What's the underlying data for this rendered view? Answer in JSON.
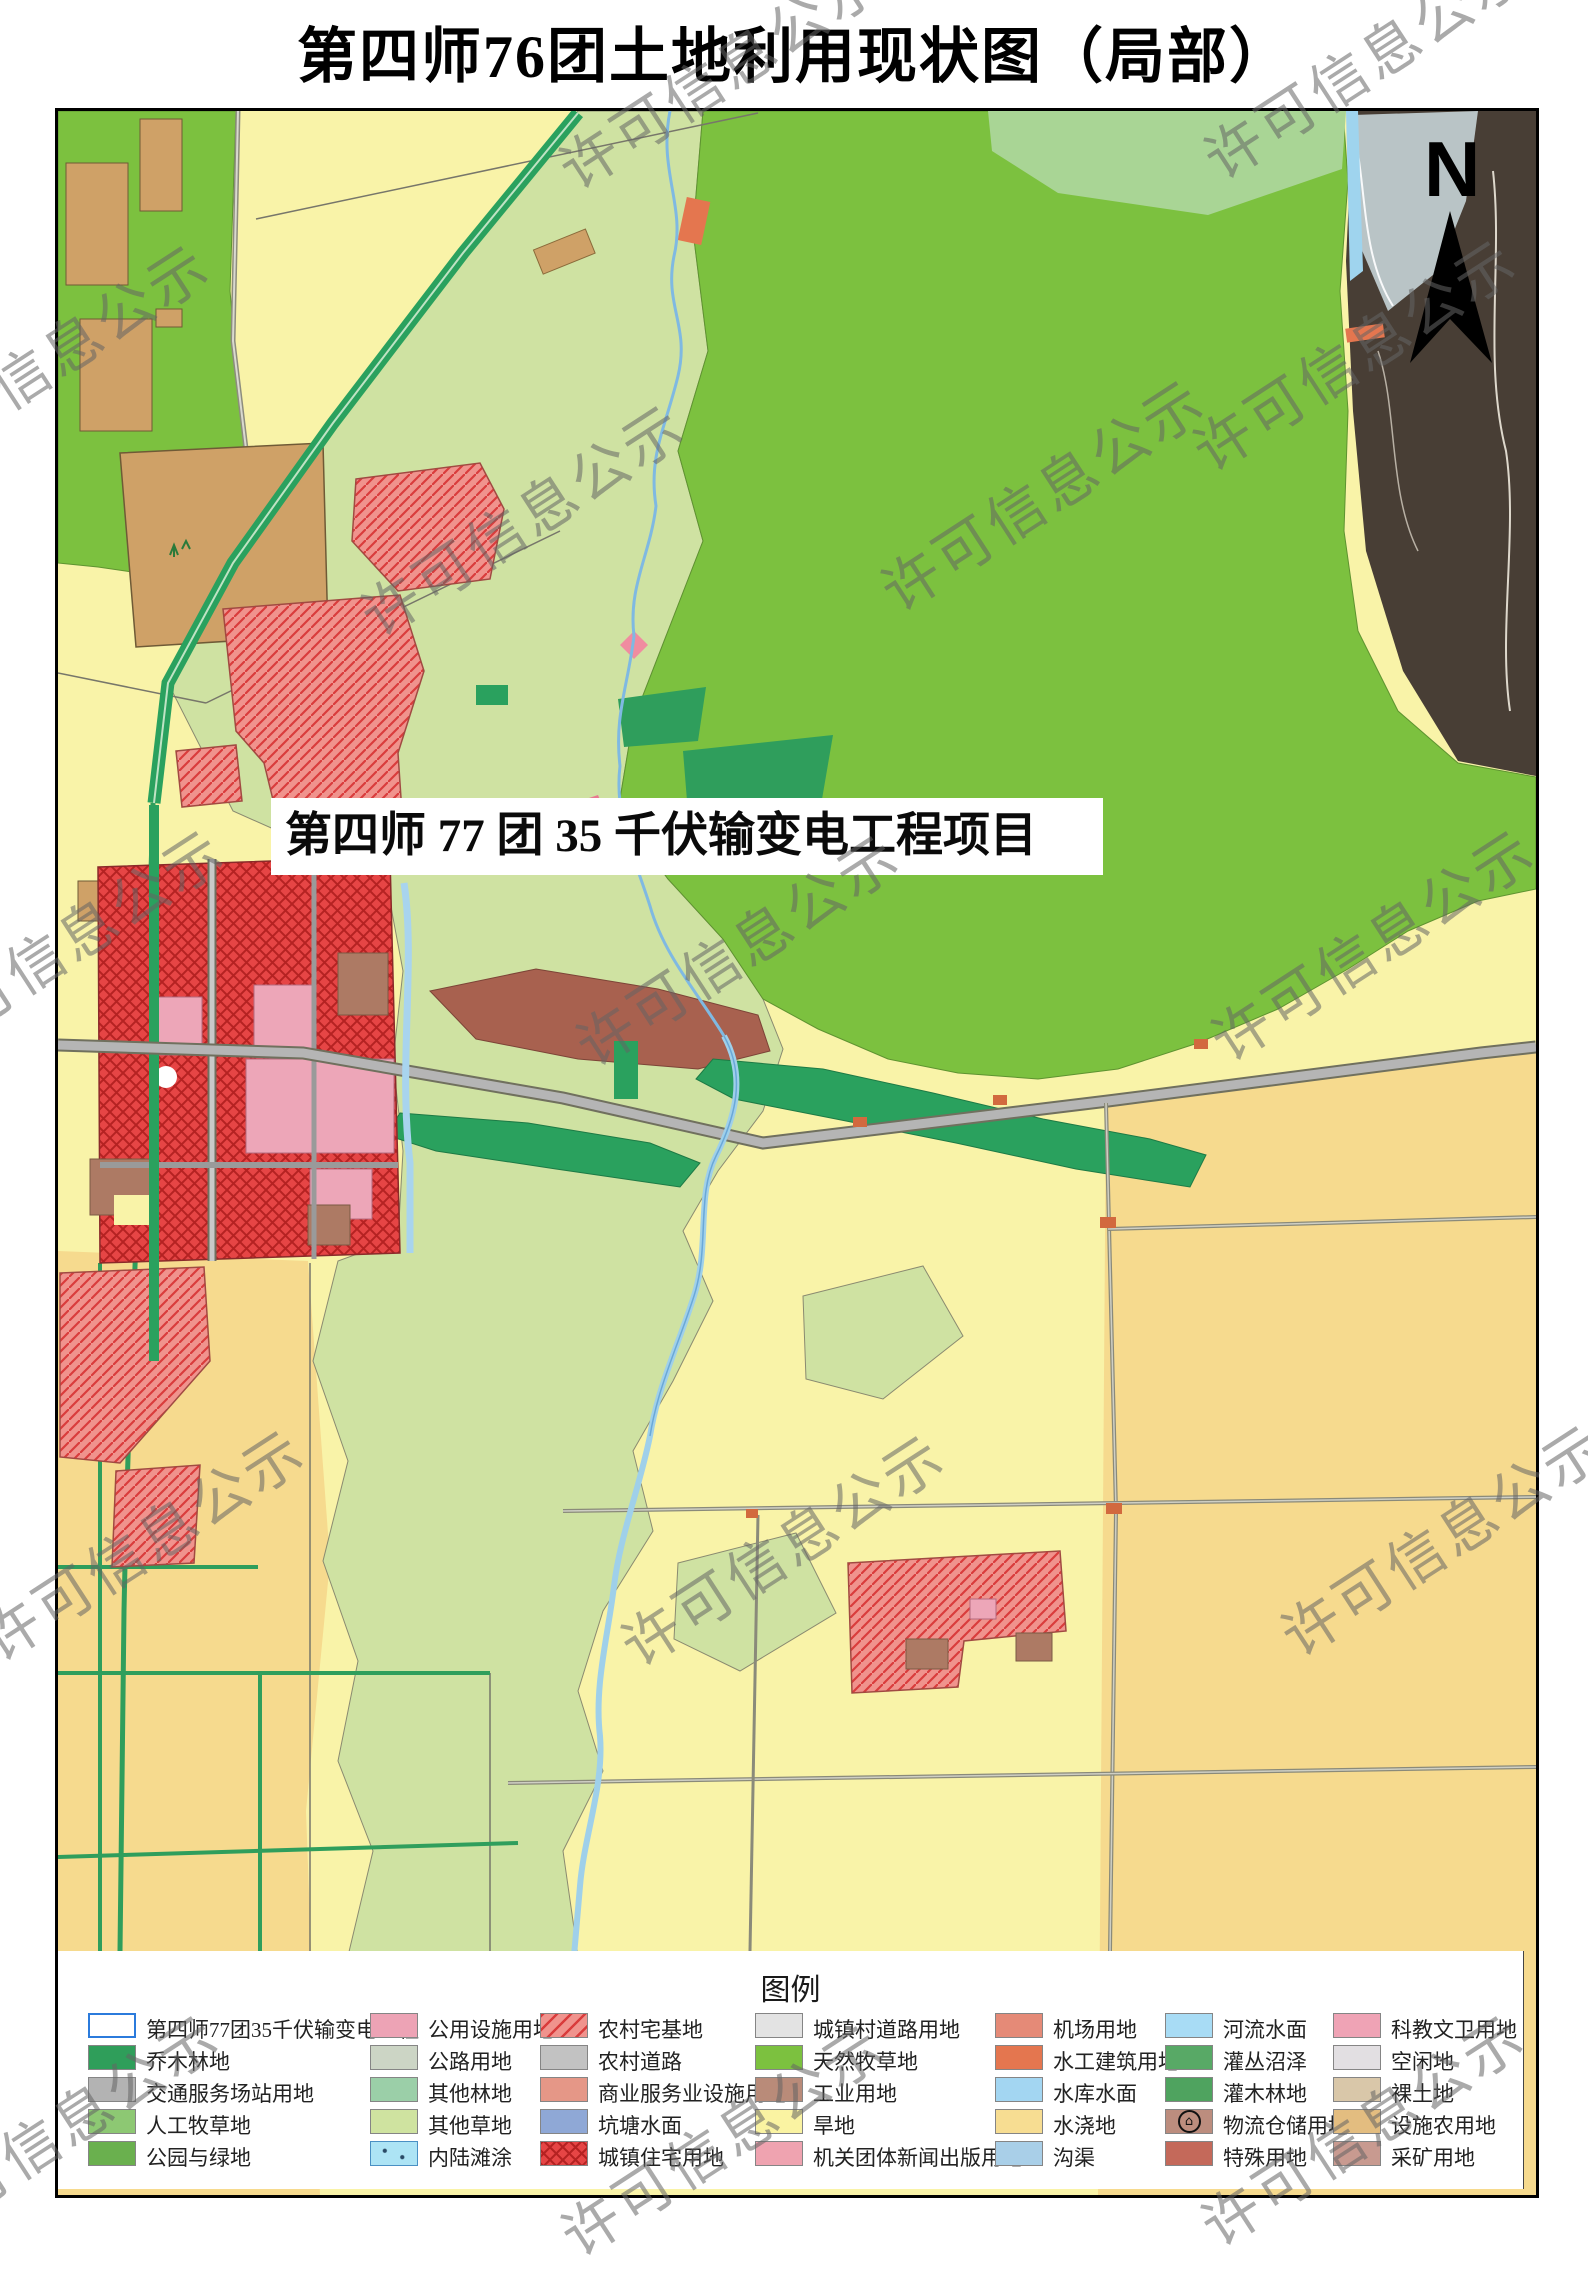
{
  "title": "第四师76团土地利用现状图（局部）",
  "map": {
    "project_label": "第四师 77 团 35 千伏输变电工程项目",
    "north_label": "N"
  },
  "watermark": {
    "text": "许可信息公示"
  },
  "legend": {
    "title": "图例",
    "columns": [
      {
        "items": [
          {
            "label": "第四师77团35千伏输变电工程",
            "color": "#ffffff",
            "pattern": "project"
          },
          {
            "label": "乔木林地",
            "color": "#2f9e5a",
            "pattern": "solid"
          },
          {
            "label": "交通服务场站用地",
            "color": "#b3b3b3",
            "pattern": "solid"
          },
          {
            "label": "人工牧草地",
            "color": "#8dc873",
            "pattern": "solid"
          },
          {
            "label": "公园与绿地",
            "color": "#6ab04e",
            "pattern": "solid"
          }
        ]
      },
      {
        "items": [
          {
            "label": "公用设施用地",
            "color": "#eda3b5",
            "pattern": "solid"
          },
          {
            "label": "公路用地",
            "color": "#ccd5c5",
            "pattern": "solid"
          },
          {
            "label": "其他林地",
            "color": "#9bcfa8",
            "pattern": "solid"
          },
          {
            "label": "其他草地",
            "color": "#cfe3a0",
            "pattern": "solid"
          },
          {
            "label": "内陆滩涂",
            "color": "#ade4f5",
            "pattern": "dots",
            "pattern_color": "#2a4a66"
          }
        ]
      },
      {
        "items": [
          {
            "label": "农村宅基地",
            "color": "#f0938d",
            "pattern": "diag",
            "pattern_color": "#d93c3c"
          },
          {
            "label": "农村道路",
            "color": "#c2c2c2",
            "pattern": "solid"
          },
          {
            "label": "商业服务业设施用地",
            "color": "#e59787",
            "pattern": "solid"
          },
          {
            "label": "坑塘水面",
            "color": "#8fa8d6",
            "pattern": "solid"
          },
          {
            "label": "城镇住宅用地",
            "color": "#e64545",
            "pattern": "cross",
            "pattern_color": "#b52222"
          }
        ]
      },
      {
        "items": [
          {
            "label": "城镇村道路用地",
            "color": "#e3e3e3",
            "pattern": "solid"
          },
          {
            "label": "天然牧草地",
            "color": "#7cc13f",
            "pattern": "solid"
          },
          {
            "label": "工业用地",
            "color": "#b98b79",
            "pattern": "solid"
          },
          {
            "label": "旱地",
            "color": "#faf3a2",
            "pattern": "solid"
          },
          {
            "label": "机关团体新闻出版用地",
            "color": "#efa3b0",
            "pattern": "solid"
          }
        ]
      },
      {
        "items": [
          {
            "label": "机场用地",
            "color": "#e58a77",
            "pattern": "solid"
          },
          {
            "label": "水工建筑用地",
            "color": "#e4764f",
            "pattern": "solid"
          },
          {
            "label": "水库水面",
            "color": "#a3d6f2",
            "pattern": "solid"
          },
          {
            "label": "水浇地",
            "color": "#f7dd92",
            "pattern": "solid"
          },
          {
            "label": "沟渠",
            "color": "#a9cfe8",
            "pattern": "solid"
          }
        ]
      },
      {
        "items": [
          {
            "label": "河流水面",
            "color": "#a8dcf5",
            "pattern": "solid"
          },
          {
            "label": "灌丛沼泽",
            "color": "#58a966",
            "pattern": "solid"
          },
          {
            "label": "灌木林地",
            "color": "#4fa35f",
            "pattern": "solid"
          },
          {
            "label": "物流仓储用地",
            "color": "#bc8d7e",
            "pattern": "warehouse"
          },
          {
            "label": "特殊用地",
            "color": "#c4695a",
            "pattern": "solid"
          }
        ]
      },
      {
        "items": [
          {
            "label": "科教文卫用地",
            "color": "#efa3b5",
            "pattern": "solid"
          },
          {
            "label": "空闲地",
            "color": "#e2dfe2",
            "pattern": "solid"
          },
          {
            "label": "裸土地",
            "color": "#d9c7a9",
            "pattern": "solid"
          },
          {
            "label": "设施农用地",
            "color": "#e3bd80",
            "pattern": "solid"
          },
          {
            "label": "采矿用地",
            "color": "#c89a90",
            "pattern": "solid"
          }
        ]
      }
    ]
  }
}
